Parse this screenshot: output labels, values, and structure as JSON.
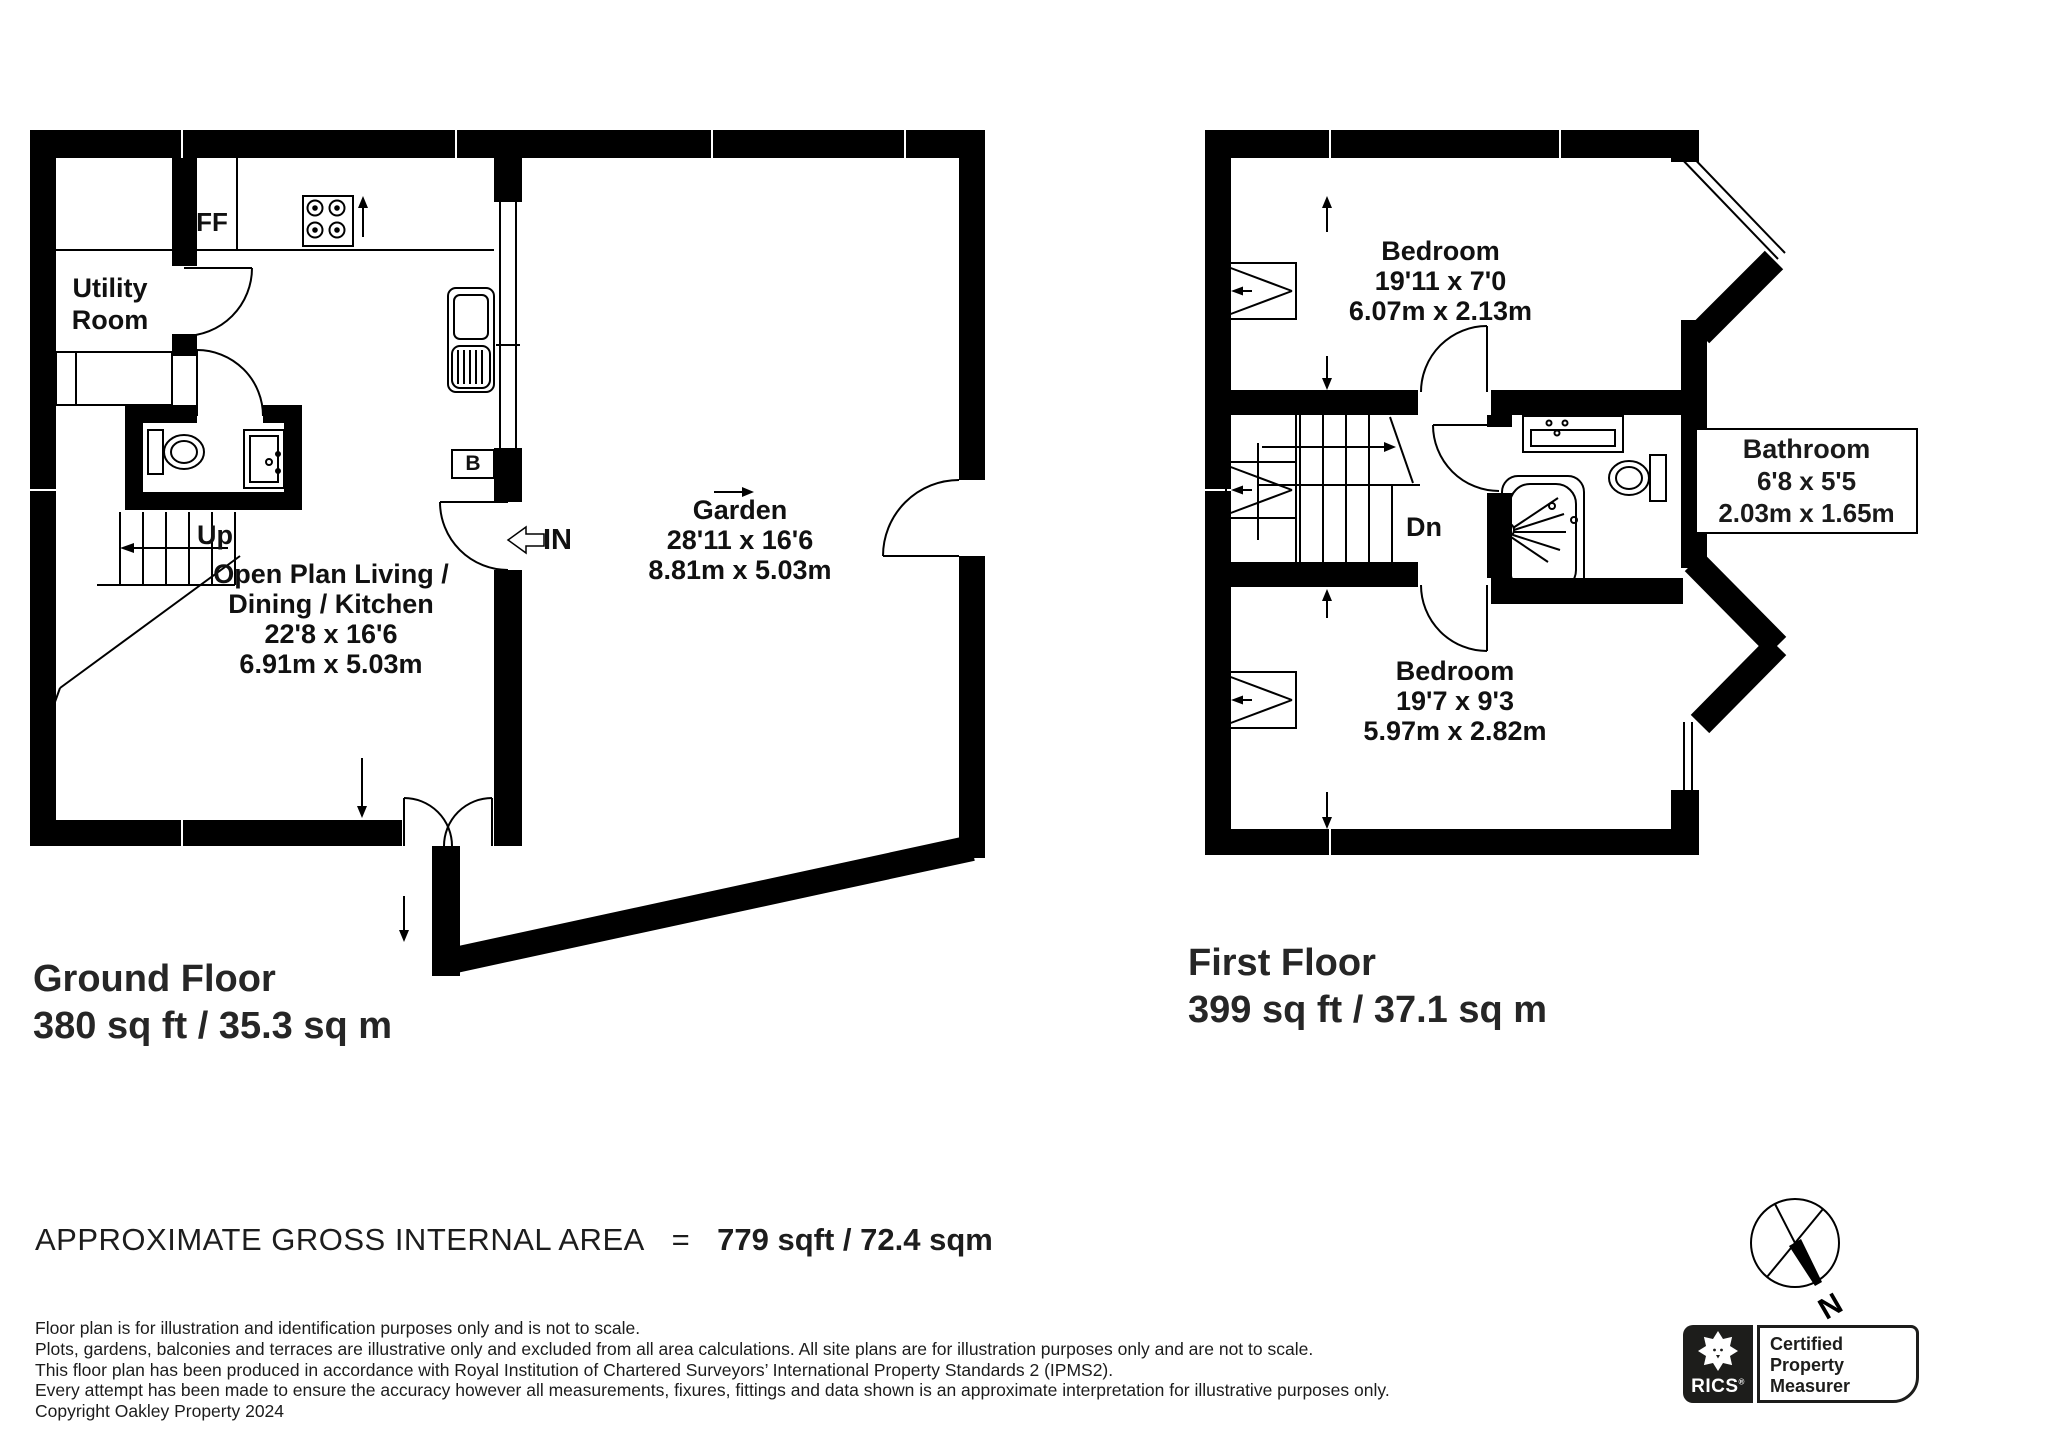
{
  "palette": {
    "ink": "#000000",
    "text": "#1a1a1a",
    "logo_black": "#1d1d1b"
  },
  "ground_floor": {
    "title": "Ground Floor",
    "area": "380 sq ft / 35.3 sq m",
    "utility_room": {
      "line1": "Utility",
      "line2": "Room"
    },
    "ff": "FF",
    "up": "Up",
    "boiler": "B",
    "entrance": "IN",
    "open_plan": {
      "line1": "Open Plan Living /",
      "line2": "Dining / Kitchen",
      "imperial": "22'8 x 16'6",
      "metric": "6.91m x 5.03m"
    },
    "garden": {
      "name": "Garden",
      "imperial": "28'11 x 16'6",
      "metric": "8.81m x 5.03m"
    }
  },
  "first_floor": {
    "title": "First Floor",
    "area": "399 sq ft / 37.1 sq m",
    "bedroom_top": {
      "name": "Bedroom",
      "imperial": "19'11 x 7'0",
      "metric": "6.07m x 2.13m"
    },
    "bathroom": {
      "name": "Bathroom",
      "imperial": "6'8 x 5'5",
      "metric": "2.03m x 1.65m"
    },
    "bedroom_bottom": {
      "name": "Bedroom",
      "imperial": "19'7 x 9'3",
      "metric": "5.97m x 2.82m"
    },
    "down": "Dn"
  },
  "summary": {
    "label": "APPROXIMATE GROSS INTERNAL AREA",
    "equals": "=",
    "value": "779 sqft / 72.4 sqm"
  },
  "disclaimer": [
    "Floor plan is for illustration and identification purposes only and is not to scale.",
    "Plots, gardens, balconies and terraces are illustrative only and excluded from all area calculations. All site plans are for illustration purposes only and are not to scale.",
    "This floor plan has been produced in accordance with Royal Institution of Chartered Surveyors’ International Property Standards 2 (IPMS2).",
    "Every attempt has been made to ensure the accuracy however all measurements, fixures, fittings and data shown is an approximate interpretation for illustrative purposes only.",
    "Copyright Oakley Property 2024"
  ],
  "compass": {
    "north": "N"
  },
  "rics_logo": {
    "brand": "RICS",
    "registered": "®",
    "badge": {
      "line1": "Certified",
      "line2": "Property",
      "line3": "Measurer"
    }
  }
}
